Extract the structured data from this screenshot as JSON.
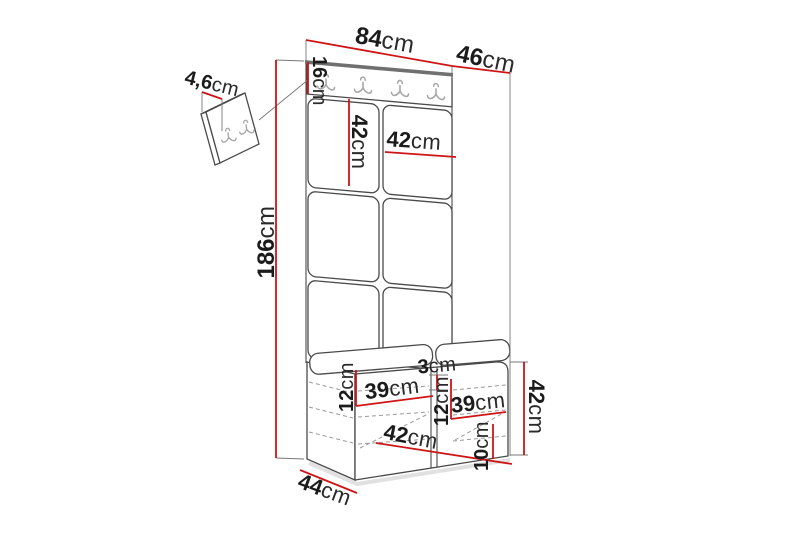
{
  "diagram": {
    "subject": "hallway-unit-dimension-diagram",
    "unit_of_measure": "cm",
    "colors": {
      "dimension_line": "#cf1416",
      "furniture_outline": "#4a4a4a",
      "hidden_edge_dashed": "#999999",
      "hook_metal": "#a8a8a8",
      "background": "#ffffff"
    },
    "hook_counts": {
      "rail_hooks": 4,
      "wall_panel_hooks": 2
    }
  },
  "labels": {
    "width_top": {
      "num": "84",
      "unit": "cm"
    },
    "depth_top": {
      "num": "46",
      "unit": "cm"
    },
    "rail_height": {
      "num": "16",
      "unit": "cm"
    },
    "panel_height": {
      "num": "42",
      "unit": "cm"
    },
    "panel_width": {
      "num": "42",
      "unit": "cm"
    },
    "total_height": {
      "num": "186",
      "unit": "cm"
    },
    "wall_panel_depth": {
      "num": "4,6",
      "unit": "cm"
    },
    "seat_thickness": {
      "num": "3",
      "unit": "cm"
    },
    "left_shelf_gap": {
      "num": "12",
      "unit": "cm"
    },
    "left_shelf_width": {
      "num": "39",
      "unit": "cm"
    },
    "mid_shelf_gap": {
      "num": "12",
      "unit": "cm"
    },
    "right_shelf_width": {
      "num": "39",
      "unit": "cm"
    },
    "bottom_shelf_height": {
      "num": "10",
      "unit": "cm"
    },
    "bench_inner_width": {
      "num": "42",
      "unit": "cm"
    },
    "bench_depth": {
      "num": "44",
      "unit": "cm"
    },
    "bench_height": {
      "num": "42",
      "unit": "cm"
    }
  }
}
